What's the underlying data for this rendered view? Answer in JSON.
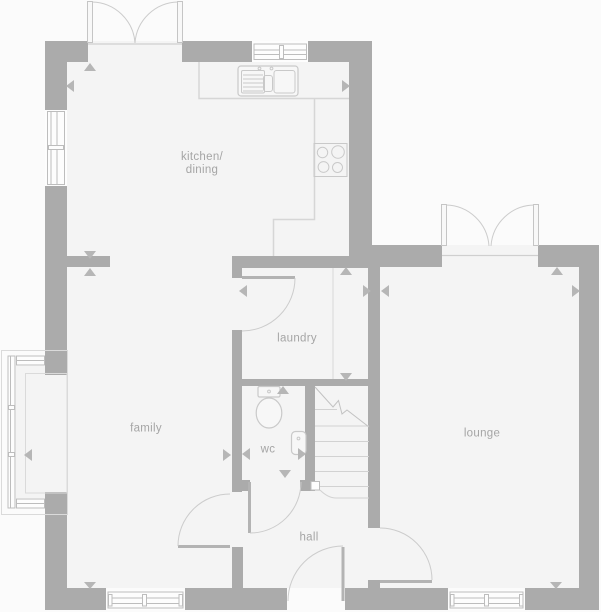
{
  "plan": {
    "title": "ground floor plan",
    "rooms": {
      "kitchen_dining": {
        "label_line1": "kitchen/",
        "label_line2": "dining"
      },
      "family": {
        "label": "family"
      },
      "laundry": {
        "label": "laundry"
      },
      "wc": {
        "label": "wc"
      },
      "hall": {
        "label": "hall"
      },
      "lounge": {
        "label": "lounge"
      }
    },
    "fixtures": [
      "sink",
      "hob",
      "toilet",
      "basin",
      "stairs",
      "bay-window",
      "french-doors",
      "front-door"
    ],
    "colors": {
      "background": "#fbfbfb",
      "floor": "#f4f4f4",
      "wall": "#ababab",
      "fixture_line": "#c9c9c9",
      "door_arc": "#cccccc",
      "door_leaf": "#b3b3b3",
      "window_frame": "#bdbdbd",
      "dimension_arrow": "#b6b6b6",
      "label_text": "#a5a5a5"
    }
  }
}
